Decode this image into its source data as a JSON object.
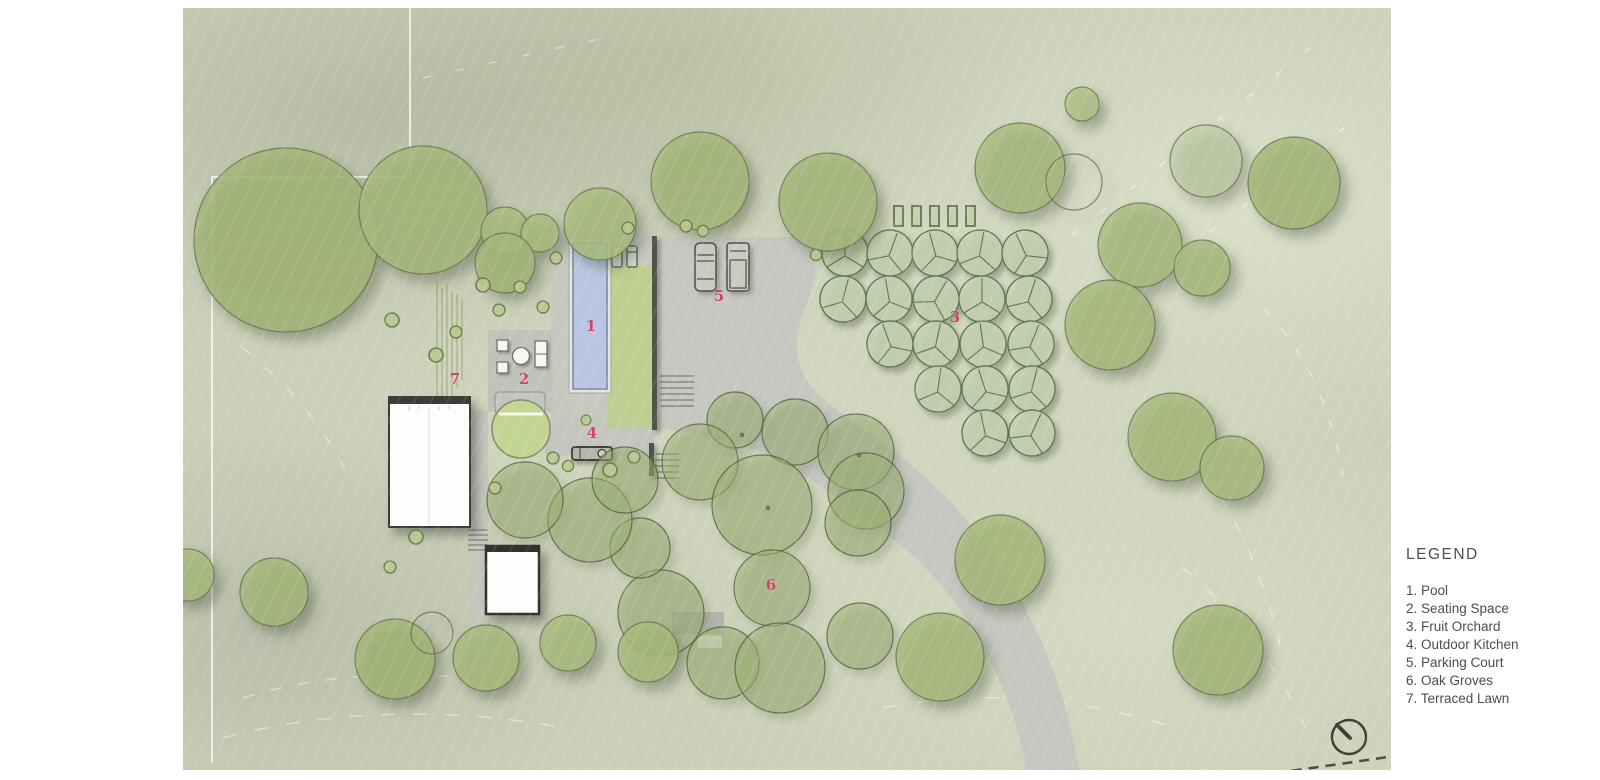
{
  "legend": {
    "title": "LEGEND",
    "items": [
      "1. Pool",
      "2. Seating Space",
      "3. Fruit Orchard",
      "4. Outdoor Kitchen",
      "5. Parking Court",
      "6. Oak Groves",
      "7. Terraced Lawn"
    ]
  },
  "plan": {
    "markers": [
      {
        "label": "1"
      },
      {
        "label": "2"
      },
      {
        "label": "3"
      },
      {
        "label": "4"
      },
      {
        "label": "5"
      },
      {
        "label": "6"
      },
      {
        "label": "7"
      }
    ]
  },
  "compass": {
    "type": "north-arrow"
  },
  "colors": {
    "marker": "#cf4468",
    "legend_text": "#4d4d4d",
    "sheet_base": "#cbd1b8",
    "canopy_fill": "#a6b97c",
    "orchard_fill": "#c5d2b2",
    "grove_fill": "#9db273",
    "paving": "#c5c7c0",
    "pool_water": "#b9c6e3",
    "lawn": "#bdd08d",
    "building": "#fdfdfc",
    "wall": "#4e5347"
  }
}
